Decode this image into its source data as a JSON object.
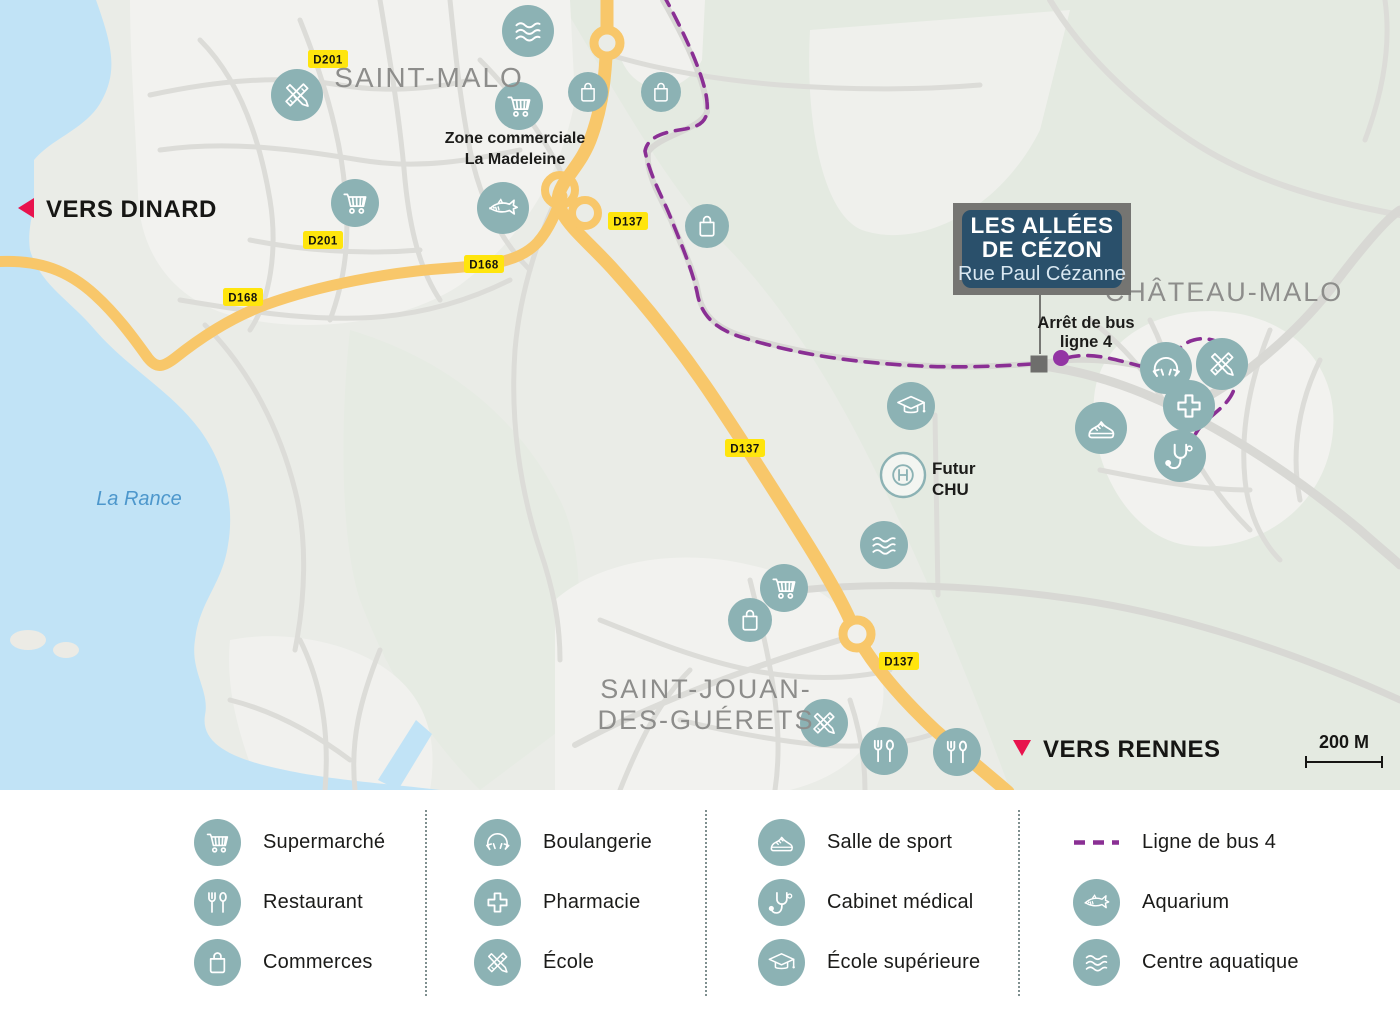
{
  "colors": {
    "icon_teal": "#8cb2b4",
    "road_yellow": "#f8c76a",
    "bus_purple": "#8a2f94",
    "bus_dot": "#9334a4",
    "water": "#c1e3f6",
    "water_label": "#4d97cc",
    "badge_yellow": "#ffe50d",
    "label_gray": "#8d8d8b",
    "box_navy": "#2a506b",
    "box_border_gray": "#757572",
    "accent_red": "#e8134d"
  },
  "map": {
    "project_label": {
      "line1": "LES ALLÉES",
      "line2": "DE CÉZON",
      "subtitle": "Rue Paul Cézanne"
    },
    "direction_west": {
      "label": "VERS DINARD"
    },
    "direction_east": {
      "label": "VERS RENNES"
    },
    "scale": {
      "label": "200 M"
    },
    "water_label": {
      "text": "La Rance",
      "x": 139,
      "y": 505
    },
    "cities": [
      {
        "name": "saint-malo",
        "lines": [
          "SAINT-MALO"
        ],
        "x": 429,
        "y": 87,
        "size": 28,
        "gap": 32
      },
      {
        "name": "chateau-malo",
        "lines": [
          "CHÂTEAU-MALO"
        ],
        "x": 1224,
        "y": 301,
        "size": 27,
        "gap": 31
      },
      {
        "name": "saint-jouan-des-guerets",
        "lines": [
          "SAINT-JOUAN-",
          "DES-GUÉRETS"
        ],
        "x": 706,
        "y": 698,
        "size": 27,
        "gap": 31
      }
    ],
    "annotations": [
      {
        "name": "zone-commerciale-la-madeleine",
        "lines": [
          "Zone commerciale",
          "La Madeleine"
        ],
        "x": 515,
        "y": 143,
        "size": 16,
        "gap": 21,
        "anchor": "middle"
      },
      {
        "name": "arret-de-bus-ligne-4",
        "lines": [
          "Arrêt de bus",
          "ligne 4"
        ],
        "x": 1086,
        "y": 328,
        "size": 16.5,
        "gap": 19,
        "anchor": "middle"
      },
      {
        "name": "futur-chu",
        "lines": [
          "Futur",
          "CHU"
        ],
        "x": 932,
        "y": 474,
        "size": 17,
        "gap": 21,
        "anchor": "start"
      }
    ],
    "road_badges": [
      {
        "label": "D201",
        "x": 328,
        "y": 59
      },
      {
        "label": "D201",
        "x": 323,
        "y": 240
      },
      {
        "label": "D168",
        "x": 484,
        "y": 264
      },
      {
        "label": "D168",
        "x": 243,
        "y": 297
      },
      {
        "label": "D137",
        "x": 628,
        "y": 221
      },
      {
        "label": "D137",
        "x": 745,
        "y": 448
      },
      {
        "label": "D137",
        "x": 899,
        "y": 661
      }
    ],
    "pois": [
      {
        "type": "waves",
        "x": 528,
        "y": 31,
        "r": 26
      },
      {
        "type": "school",
        "x": 297,
        "y": 95,
        "r": 26
      },
      {
        "type": "cart",
        "x": 519,
        "y": 106,
        "r": 24
      },
      {
        "type": "bag",
        "x": 588,
        "y": 92,
        "r": 20
      },
      {
        "type": "bag",
        "x": 661,
        "y": 92,
        "r": 20
      },
      {
        "type": "cart",
        "x": 355,
        "y": 203,
        "r": 24
      },
      {
        "type": "shark",
        "x": 503,
        "y": 208,
        "r": 26
      },
      {
        "type": "bag",
        "x": 707,
        "y": 226,
        "r": 22
      },
      {
        "type": "gradcap",
        "x": 911,
        "y": 406,
        "r": 24
      },
      {
        "type": "hospital",
        "x": 903,
        "y": 475,
        "r": 22
      },
      {
        "type": "sneaker",
        "x": 1101,
        "y": 428,
        "r": 26
      },
      {
        "type": "croissant",
        "x": 1166,
        "y": 368,
        "r": 26
      },
      {
        "type": "school",
        "x": 1222,
        "y": 364,
        "r": 26
      },
      {
        "type": "cross",
        "x": 1189,
        "y": 406,
        "r": 26
      },
      {
        "type": "stethoscope",
        "x": 1180,
        "y": 456,
        "r": 26
      },
      {
        "type": "waves",
        "x": 884,
        "y": 545,
        "r": 24
      },
      {
        "type": "cart",
        "x": 784,
        "y": 588,
        "r": 24
      },
      {
        "type": "bag",
        "x": 750,
        "y": 620,
        "r": 22
      },
      {
        "type": "school",
        "x": 824,
        "y": 723,
        "r": 24
      },
      {
        "type": "restaurant",
        "x": 884,
        "y": 751,
        "r": 24
      },
      {
        "type": "restaurant",
        "x": 957,
        "y": 752,
        "r": 24
      }
    ]
  },
  "legend": {
    "columns": [
      {
        "items": [
          {
            "icon": "cart",
            "label": "Supermarché"
          },
          {
            "icon": "restaurant",
            "label": "Restaurant"
          },
          {
            "icon": "bag",
            "label": "Commerces"
          }
        ]
      },
      {
        "items": [
          {
            "icon": "croissant",
            "label": "Boulangerie"
          },
          {
            "icon": "cross",
            "label": "Pharmacie"
          },
          {
            "icon": "school",
            "label": "École"
          }
        ]
      },
      {
        "items": [
          {
            "icon": "sneaker",
            "label": "Salle de sport"
          },
          {
            "icon": "stethoscope",
            "label": "Cabinet médical"
          },
          {
            "icon": "gradcap",
            "label": "École supérieure"
          }
        ]
      },
      {
        "items": [
          {
            "icon": "bus-line",
            "label": "Ligne de bus 4"
          },
          {
            "icon": "shark",
            "label": "Aquarium"
          },
          {
            "icon": "waves",
            "label": "Centre aquatique"
          }
        ]
      }
    ]
  }
}
